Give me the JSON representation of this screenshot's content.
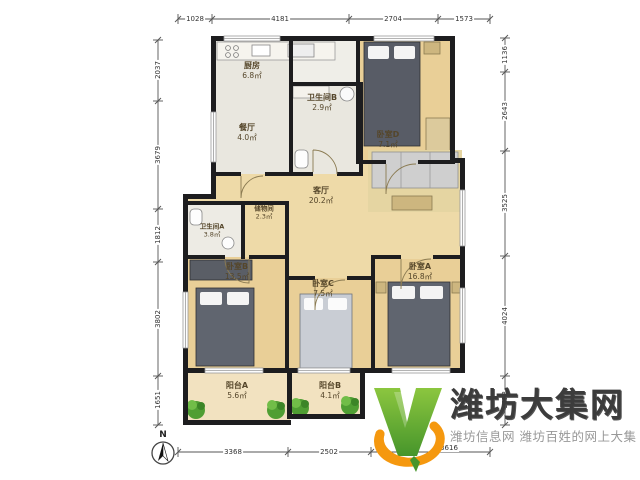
{
  "plan": {
    "compass": "N",
    "rooms": {
      "kitchen": {
        "name": "厨房",
        "area": "6.8㎡"
      },
      "bath_b": {
        "name": "卫生间B",
        "area": "2.9㎡"
      },
      "dining": {
        "name": "餐厅",
        "area": "4.0㎡"
      },
      "bedroom_d": {
        "name": "卧室D",
        "area": "7.1㎡"
      },
      "living": {
        "name": "客厅",
        "area": "20.2㎡"
      },
      "storage": {
        "name": "储物间",
        "area": "2.3㎡"
      },
      "bath_a": {
        "name": "卫生间A",
        "area": "3.8㎡"
      },
      "bedroom_b": {
        "name": "卧室B",
        "area": "13.5㎡"
      },
      "bedroom_c": {
        "name": "卧室C",
        "area": "7.5㎡"
      },
      "bedroom_a": {
        "name": "卧室A",
        "area": "16.8㎡"
      },
      "balcony_a": {
        "name": "阳台A",
        "area": "5.6㎡"
      },
      "balcony_b": {
        "name": "阳台B",
        "area": "4.1㎡"
      }
    },
    "dimensions": {
      "top": [
        "1028",
        "4181",
        "2704",
        "1573"
      ],
      "bottom": [
        "3368",
        "2502",
        "3616"
      ],
      "left": [
        "2037",
        "3679",
        "1812",
        "3802",
        "1651"
      ],
      "right": [
        "1136",
        "2643",
        "3525",
        "4024",
        "1653"
      ]
    }
  },
  "watermark": {
    "title": "潍坊大集网",
    "subtitle": "潍坊信息网 潍坊百姓的网上大集",
    "brand_green": "#5fa830",
    "brand_orange": "#f5980f",
    "title_color": "#3c3c3c",
    "subtitle_color": "#989898"
  }
}
